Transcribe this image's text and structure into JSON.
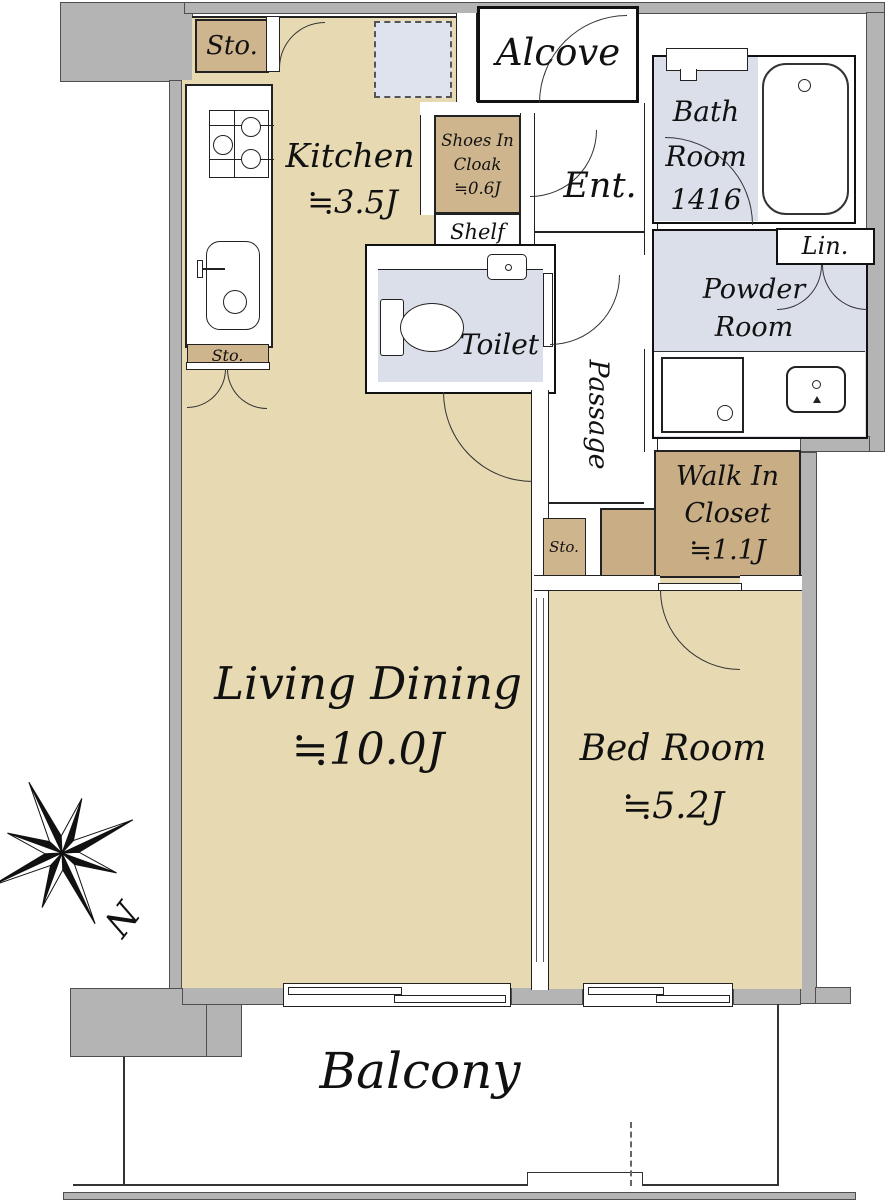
{
  "plan": {
    "type": "apartment-floor-plan",
    "compass": {
      "north_label": "N"
    },
    "colors": {
      "room_floor": "#e7dab3",
      "storage_floor": "#cfb58e",
      "closet_floor": "#c9ad85",
      "wet_area_floor": "#dbdfea",
      "structural_wall": "#b4b4b4",
      "text": "#111111"
    },
    "rooms": {
      "kitchen": {
        "name": "Kitchen",
        "size": "≒3.5J"
      },
      "living": {
        "name": "Living Dining",
        "size": "≒10.0J"
      },
      "bedroom": {
        "name": "Bed Room",
        "size": "≒5.2J"
      },
      "alcove": {
        "name": "Alcove"
      },
      "entrance": {
        "name": "Ent."
      },
      "shoes_in_cloak": {
        "line1": "Shoes In",
        "line2": "Cloak",
        "size": "≒0.6J"
      },
      "shelf": {
        "name": "Shelf"
      },
      "bathroom": {
        "line1": "Bath",
        "line2": "Room",
        "line3": "1416"
      },
      "linen": {
        "name": "Lin."
      },
      "powder_room": {
        "line1": "Powder",
        "line2": "Room"
      },
      "toilet": {
        "name": "Toilet"
      },
      "passage": {
        "name": "Passage"
      },
      "walk_in_closet": {
        "line1": "Walk In",
        "line2": "Closet",
        "size": "≒1.1J"
      },
      "balcony": {
        "name": "Balcony"
      },
      "storage_top": {
        "name": "Sto."
      },
      "storage_mid": {
        "name": "Sto."
      },
      "storage_small": {
        "name": "Sto."
      }
    },
    "fixtures": [
      "gas-stove-icon",
      "kitchen-sink-icon",
      "refrigerator-space",
      "bathtub-icon",
      "toilet-icon",
      "toilet-sink-icon",
      "washing-machine-space-icon",
      "vanity-sink-icon",
      "compass-rose-icon"
    ]
  }
}
